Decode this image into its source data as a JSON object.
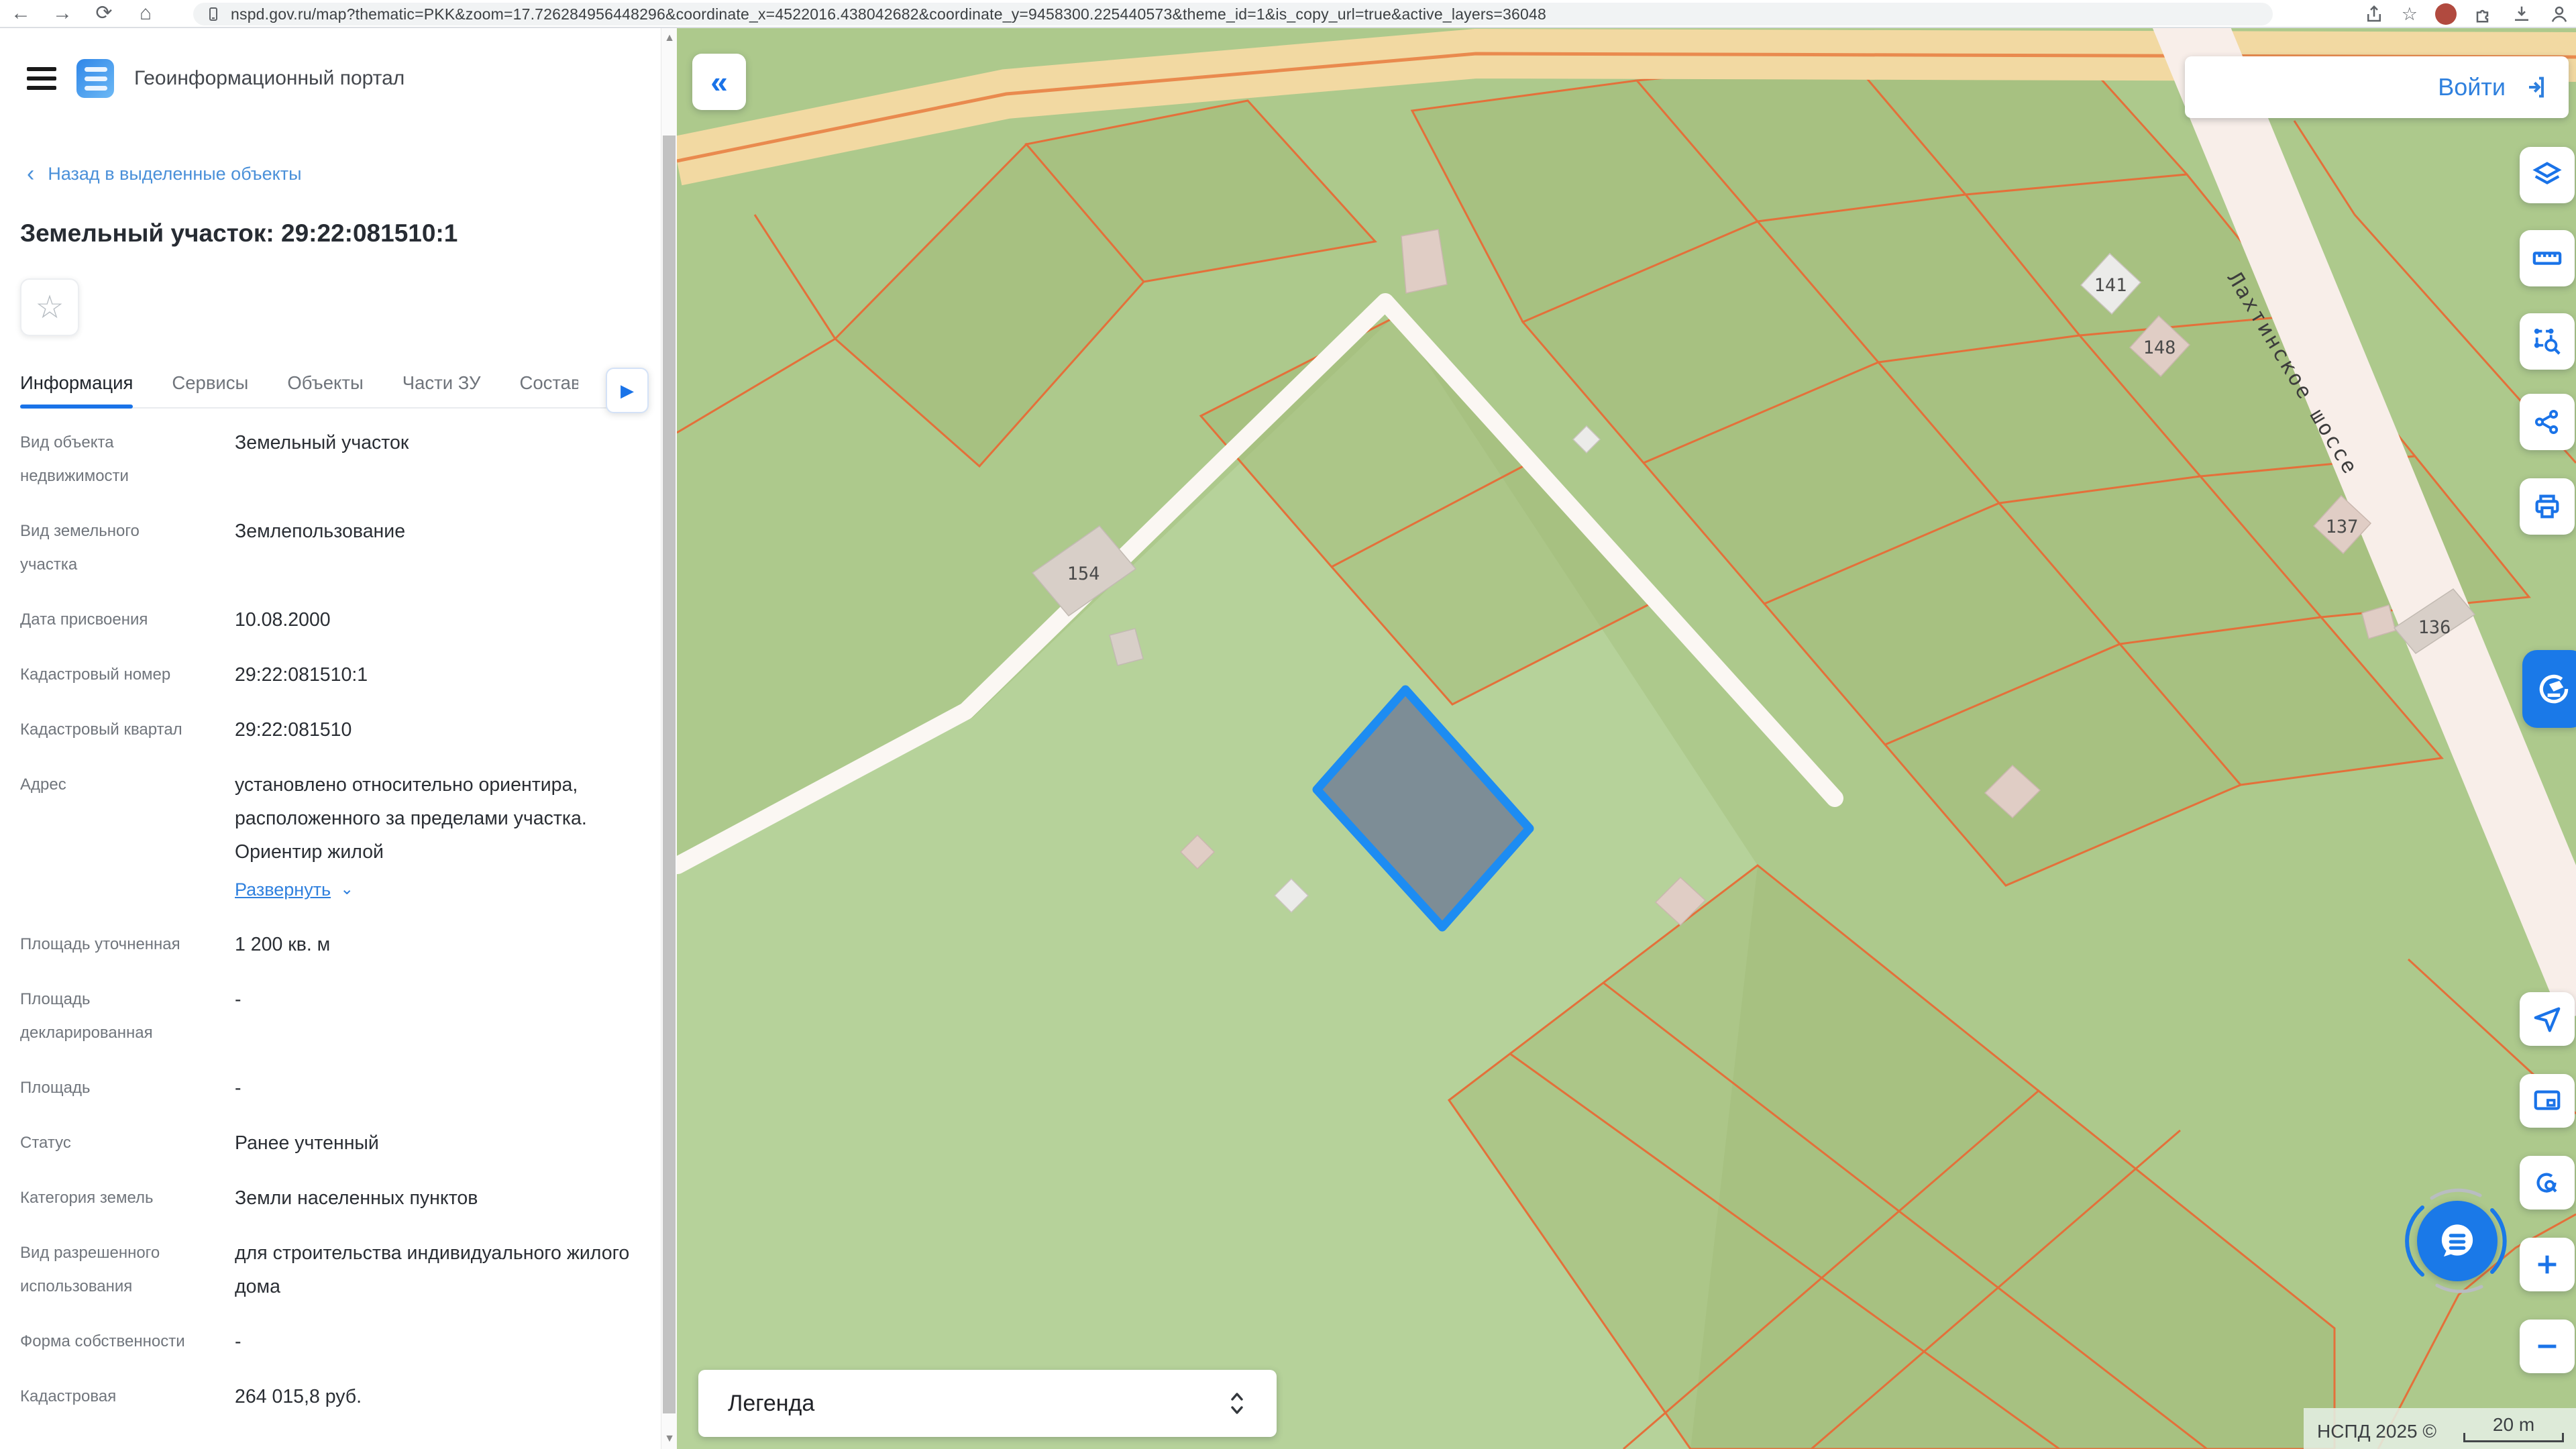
{
  "browser": {
    "url": "nspd.gov.ru/map?thematic=PKK&zoom=17.726284956448296&coordinate_x=4522016.438042682&coordinate_y=9458300.225440573&theme_id=1&is_copy_url=true&active_layers=36048"
  },
  "header": {
    "portal_title": "Геоинформационный портал"
  },
  "sidebar": {
    "back_link": "Назад в выделенные объекты",
    "object_title": "Земельный участок: 29:22:081510:1",
    "tabs": [
      {
        "label": "Информация",
        "active": true
      },
      {
        "label": "Сервисы",
        "active": false
      },
      {
        "label": "Объекты",
        "active": false
      },
      {
        "label": "Части ЗУ",
        "active": false
      },
      {
        "label": "Состав",
        "active": false
      }
    ],
    "fields": [
      {
        "label": "Вид объекта недвижимости",
        "value": "Земельный участок"
      },
      {
        "label": "Вид земельного участка",
        "value": "Землепользование"
      },
      {
        "label": "Дата присвоения",
        "value": "10.08.2000"
      },
      {
        "label": "Кадастровый номер",
        "value": "29:22:081510:1"
      },
      {
        "label": "Кадастровый квартал",
        "value": "29:22:081510"
      },
      {
        "label": "Адрес",
        "value": "установлено относительно ориентира, расположенного за пределами участка. Ориентир жилой",
        "link": "Развернуть"
      },
      {
        "label": "Площадь уточненная",
        "value": "1 200 кв. м"
      },
      {
        "label": "Площадь декларированная",
        "value": "-"
      },
      {
        "label": "Площадь",
        "value": "-"
      },
      {
        "label": "Статус",
        "value": "Ранее учтенный"
      },
      {
        "label": "Категория земель",
        "value": "Земли населенных пунктов"
      },
      {
        "label": "Вид разрешенного использования",
        "value": "для строительства индивидуального жилого дома"
      },
      {
        "label": "Форма собственности",
        "value": "-"
      },
      {
        "label": "Кадастровая",
        "value": "264 015,8 руб."
      }
    ]
  },
  "map": {
    "collapse_glyph": "«",
    "login_label": "Войти",
    "legend_label": "Легенда",
    "attribution": "НСПД 2025 ©",
    "scale_label": "20 m",
    "road_label": "Лахтинское шоссе",
    "parcel_labels": [
      "141",
      "148",
      "154",
      "137",
      "136"
    ],
    "colors": {
      "selected_fill": "#7d8d96",
      "selected_stroke": "#1d8cf2",
      "parcel_line": "#e4703a",
      "accent": "#1a73e8"
    }
  }
}
